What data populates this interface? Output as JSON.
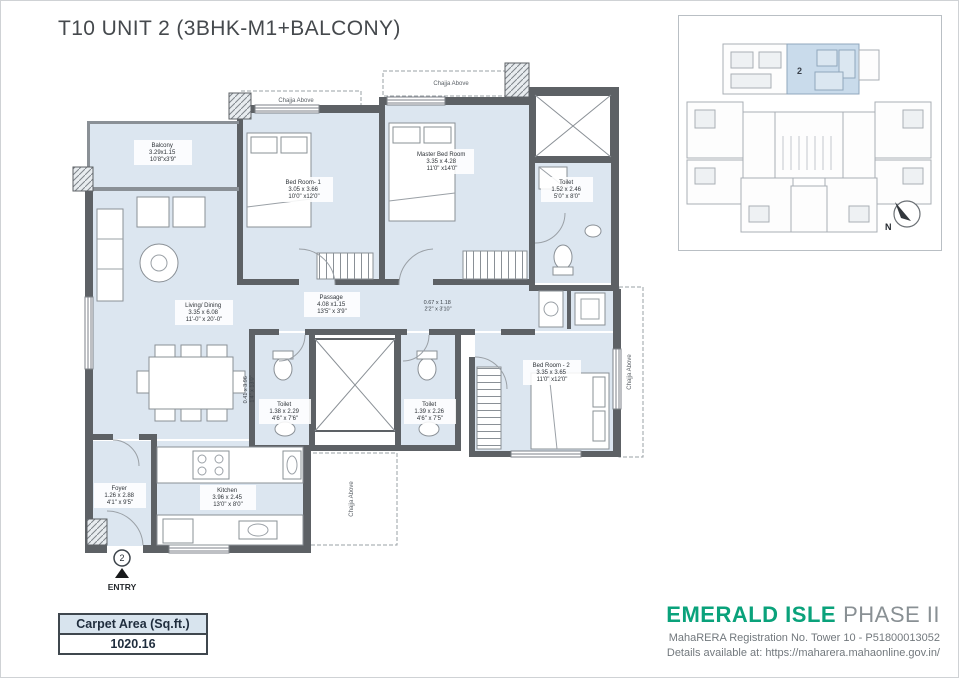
{
  "title": "T10 UNIT 2 (3BHK-M1+BALCONY)",
  "colors": {
    "brand_green": "#0aa27b",
    "floor_fill": "#dce6f0",
    "wall": "#5d6165",
    "keyplan_highlight": "#c9dbeb"
  },
  "rooms": {
    "balcony": {
      "name": "Balcony",
      "dim_m": "3.29x1.15",
      "dim_ft": "10'8\"x3'9\""
    },
    "bed1": {
      "name": "Bed Room- 1",
      "dim_m": "3.05 x 3.66",
      "dim_ft": "10'0\" x12'0\""
    },
    "master": {
      "name": "Master Bed Room",
      "dim_m": "3.35 x 4.28",
      "dim_ft": "11'0\" x14'0\""
    },
    "toilet_master": {
      "name": "Toilet",
      "dim_m": "1.52 x 2.46",
      "dim_ft": "5'0\" x 8'0\""
    },
    "living": {
      "name": "Living/ Dining",
      "dim_m": "3.35 x 6.08",
      "dim_ft": "11'-0\" x 20'-0\""
    },
    "passage": {
      "name": "Passage",
      "dim_m": "4.08 x1.15",
      "dim_ft": "13'5\" x 3'9\""
    },
    "bed2": {
      "name": "Bed Room - 2",
      "dim_m": "3.35 x 3.65",
      "dim_ft": "11'0\" x12'0\""
    },
    "toilet2": {
      "name": "Toilet",
      "dim_m": "1.38 x 2.29",
      "dim_ft": "4'6\" x 7'6\""
    },
    "toilet3": {
      "name": "Toilet",
      "dim_m": "1.39 x 2.26",
      "dim_ft": "4'6\" x 7'5\""
    },
    "kitchen": {
      "name": "Kitchen",
      "dim_m": "3.96 x 2.45",
      "dim_ft": "13'0\" x 8'0\""
    },
    "foyer": {
      "name": "Foyer",
      "dim_m": "1.26 x 2.88",
      "dim_ft": "4'1\" x 9'5\""
    }
  },
  "annotations": {
    "chajja": "Chajja Above",
    "passage_end": {
      "dim_m": "0.67 x 1.18",
      "dim_ft": "2'2\" x 3'10\""
    },
    "living_side": {
      "dim_m": "0.41 x 3.96",
      "dim_ft": "1'4\" x 13'0\""
    }
  },
  "entry": {
    "number": "2",
    "label": "ENTRY"
  },
  "key_plan": {
    "unit": "2",
    "north": "N"
  },
  "carpet": {
    "header": "Carpet Area (Sq.ft.)",
    "value": "1020.16"
  },
  "footer": {
    "brand": "EMERALD ISLE",
    "phase": "PHASE II",
    "registration": "MahaRERA Registration No. Tower 10 - P51800013052",
    "details": "Details available at: https://maharera.mahaonline.gov.in/"
  }
}
